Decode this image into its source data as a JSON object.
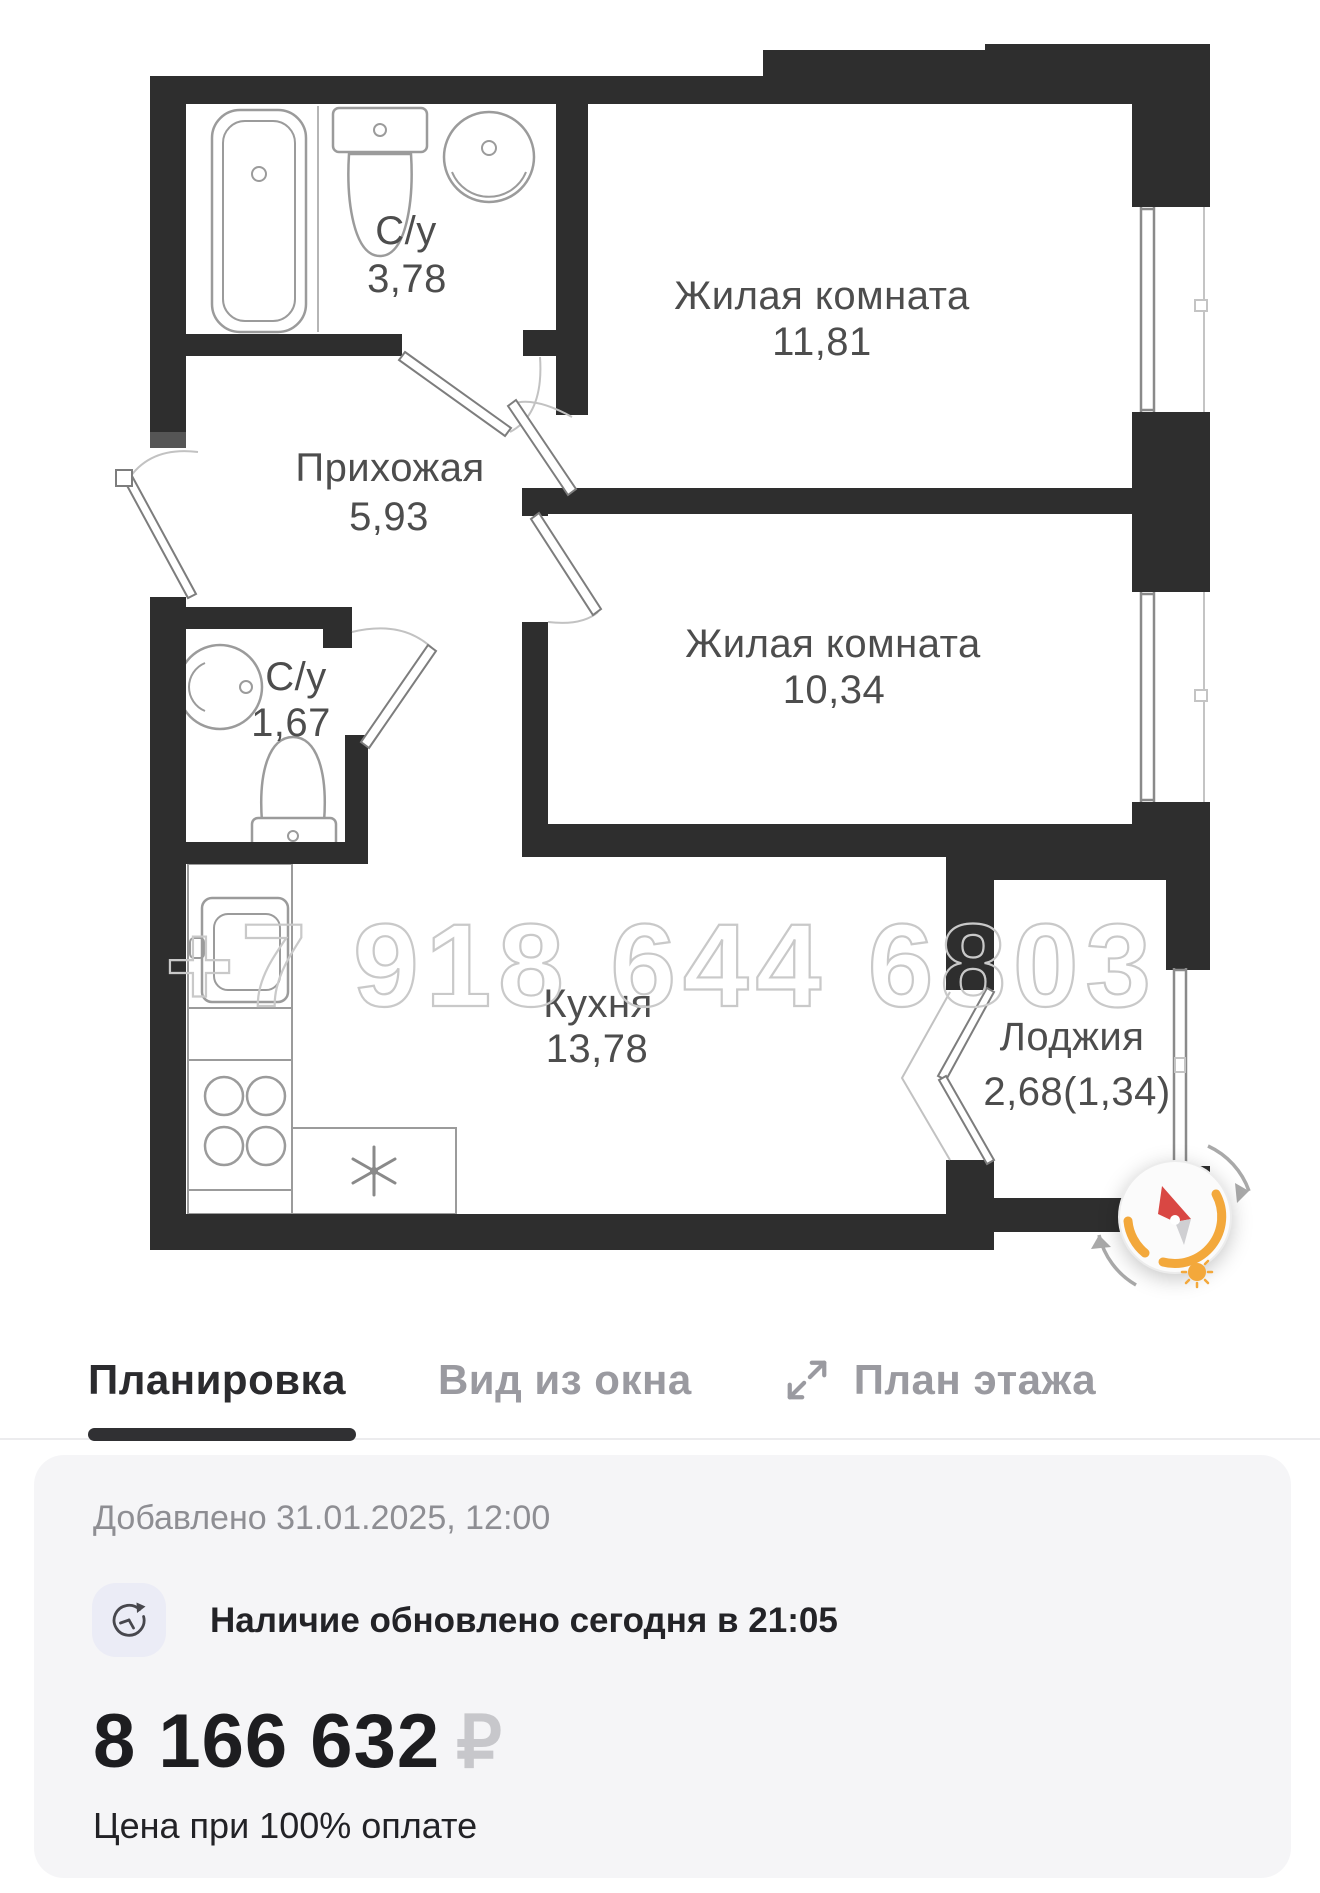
{
  "floor_plan": {
    "watermark": "+7 918 644 6803",
    "rooms": [
      {
        "name": "С/у",
        "area": "3,78"
      },
      {
        "name": "Жилая комната",
        "area": "11,81"
      },
      {
        "name": "Прихожая",
        "area": "5,93"
      },
      {
        "name": "Жилая комната",
        "area": "10,34"
      },
      {
        "name": "С/у",
        "area": "1,67"
      },
      {
        "name": "Кухня",
        "area": "13,78"
      },
      {
        "name": "Лоджия",
        "area": "2,68(1,34)"
      }
    ]
  },
  "tabs": {
    "items": [
      {
        "label": "Планировка",
        "active": true
      },
      {
        "label": "Вид из окна",
        "active": false
      },
      {
        "label": "План этажа",
        "active": false,
        "icon": "expand-icon"
      }
    ]
  },
  "info_card": {
    "added_label": "Добавлено 31.01.2025, 12:00",
    "availability_label": "Наличие обновлено сегодня в 21:05",
    "price": "8 166 632",
    "currency_symbol": "₽",
    "price_caption": "Цена при 100% оплате"
  },
  "colors": {
    "wall": "#2e2e2e",
    "accent_orange": "#f3a83b",
    "needle_red": "#d94743",
    "active_tab": "#2b2b2e",
    "inactive_tab": "#9a9aa0",
    "card_background": "#f5f5f7",
    "watermark": "#c9c9c9"
  }
}
